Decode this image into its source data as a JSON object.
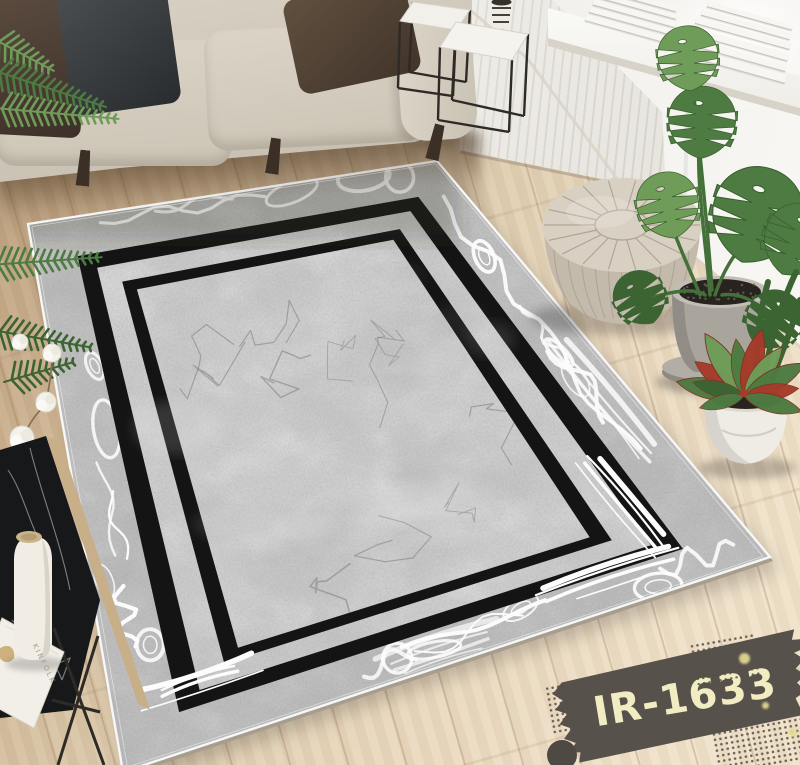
{
  "label": {
    "text": "IR-1633",
    "bg": "#56514a",
    "fg": "#f2ecc3",
    "accent_dot": "#e3db8f"
  },
  "magazine": {
    "title": "KINFOLK"
  },
  "rug": {
    "field": "#c8c8c8",
    "band_tint": "rgba(118,118,118,0.16)",
    "frame": "#141414",
    "binding": "#f7f7f7",
    "swirl": "#fcfcfc",
    "vein": "#7d7d7d",
    "edge_side": "#a79d8d",
    "shadow": "rgba(0,0,0,0.20)"
  },
  "palette": {
    "wood_dark": "#b79b78",
    "wood_light": "#f0e2ca",
    "wall": "#f0eee9",
    "window": "#ffffff",
    "sofa": "#d5cec0",
    "pillow_brown": "#4b3d34",
    "pillow_charcoal": "#34383b",
    "pillow_taupe": "#554538",
    "pouf_top": "#d8d0c3",
    "pouf_side": "#c4baac",
    "pouf_seam": "#ab9f8c",
    "leaf": "#4d7b41",
    "leaf_dark": "#3c6433",
    "leaf_light": "#6f9c58",
    "stem": "#44703a",
    "croton_red": "#a63b2a",
    "pot_concrete": "#a9a59c",
    "pot_white": "#efece5",
    "soil": "#28231e",
    "cotton": "#f5f2ec",
    "slab": "#17181a",
    "slab_vein": "#d0d3d5",
    "bottle": "#f1ede4",
    "cork": "#c9b48b",
    "metal": "#2e2b27",
    "radiator": "#f3f1ec",
    "sill": "#fafaf7"
  }
}
